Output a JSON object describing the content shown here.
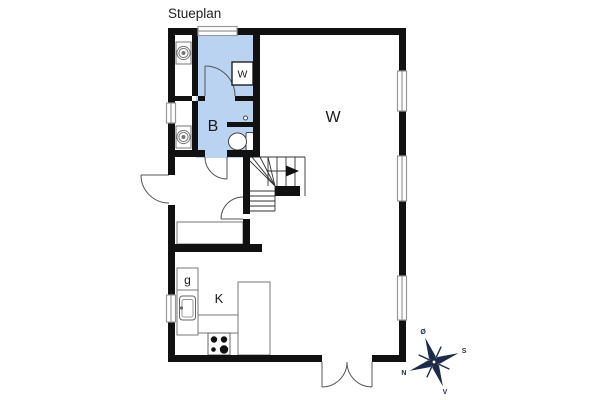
{
  "title": "Stueplan",
  "plan": {
    "rooms": {
      "living_label": "W",
      "bath_label": "B",
      "bath_cabinet_label": "W",
      "kitchen_label": "K",
      "kitchen_cell_label": "g"
    },
    "colors": {
      "wall": "#111111",
      "bath_fill": "#b9d3f1",
      "fixture_line": "#888888",
      "compass_navy": "#1c2b4a"
    }
  },
  "compass": {
    "n": "N",
    "s": "S",
    "e": "Ø",
    "w": "V"
  }
}
